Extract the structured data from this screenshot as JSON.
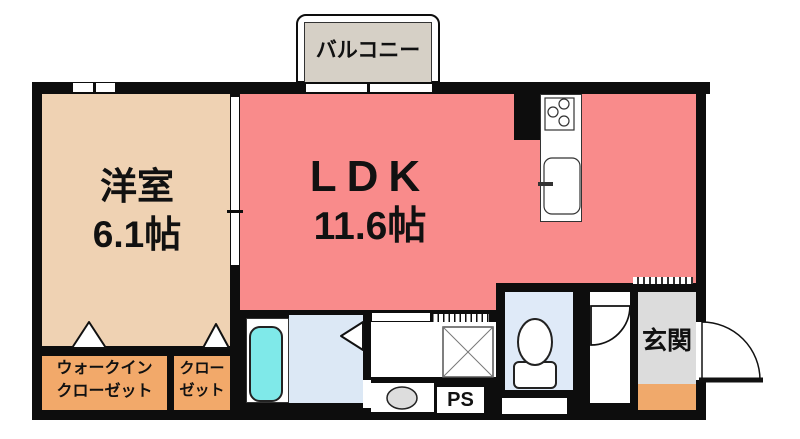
{
  "rooms": {
    "balcony": {
      "label": "バルコニー"
    },
    "western_room": {
      "label": "洋室",
      "size": "6.1帖"
    },
    "ldk": {
      "label": "LDK",
      "size": "11.6帖"
    },
    "walk_in_closet": {
      "label_line1": "ウォークイン",
      "label_line2": "クローゼット"
    },
    "closet": {
      "label_line1": "クロー",
      "label_line2": "ゼット"
    },
    "entrance": {
      "label": "玄関"
    },
    "pipe_space": {
      "label": "PS"
    }
  },
  "icons": {
    "kitchen_stove": "gas-stove-3-burners",
    "kitchen_sink": "kitchen-sink-with-faucet",
    "bathtub": "bathtub",
    "washer_pan": "washing-machine-pan",
    "toilet": "toilet",
    "washbasin": "washbasin",
    "folding_doors": "triangle-door-symbols",
    "swing_doors": "quarter-circle-door-arcs"
  },
  "colors": {
    "wall": "#0d0d0d",
    "ldk": "#f98b8b",
    "western_room": "#efd2b3",
    "closet": "#f2a96a",
    "balcony": "#d6d0c6",
    "bath_floor": "#dce8f5",
    "bathtub": "#7fe9e9",
    "toilet_floor": "#dfeaf8",
    "entrance_floor": "#dcdcdc",
    "entrance_step": "#f0a96b"
  }
}
